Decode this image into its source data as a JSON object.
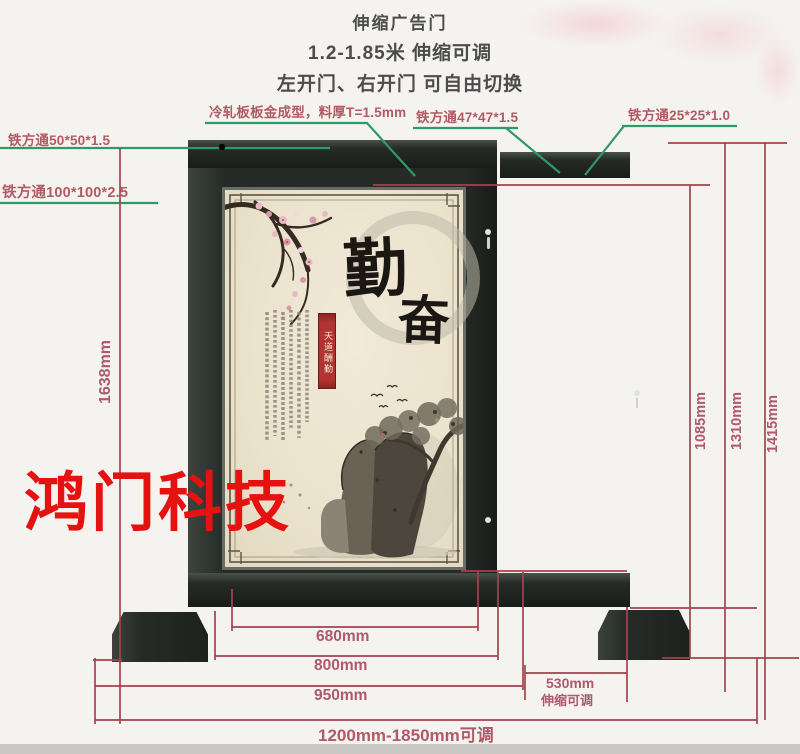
{
  "title": {
    "product": "伸缩广告门",
    "range": "1.2-1.85米 伸缩可调",
    "switch": "左开门、右开门 可自由切换"
  },
  "callouts": {
    "tube_50": "铁方通50*50*1.5",
    "tube_100": "铁方通100*100*2.5",
    "cold_rolled": "冷轧板板金成型，料厚T=1.5mm",
    "tube_47": "铁方通47*47*1.5",
    "tube_25": "铁方通25*25*1.0"
  },
  "dims": {
    "h1638": "1638mm",
    "h1085": "1085mm",
    "h1310": "1310mm",
    "h1415": "1415mm",
    "w680": "680mm",
    "w800": "800mm",
    "w950": "950mm",
    "w530": "530mm",
    "w530_note": "伸缩可调",
    "w_total": "1200mm-1850mm可调"
  },
  "watermark": {
    "text": "鸿门科技"
  },
  "panel": {
    "cal_top": "勤",
    "cal_bottom": "奋",
    "banner": "天道酬勤"
  },
  "colors": {
    "dimension_line": "#a2434d",
    "leader_line": "#2f9a67",
    "label_text": "#b25a63",
    "title_text": "#4c4c4c",
    "watermark": "#e61212",
    "metal": "#272c28",
    "panel_bg": "#ece4cf"
  }
}
